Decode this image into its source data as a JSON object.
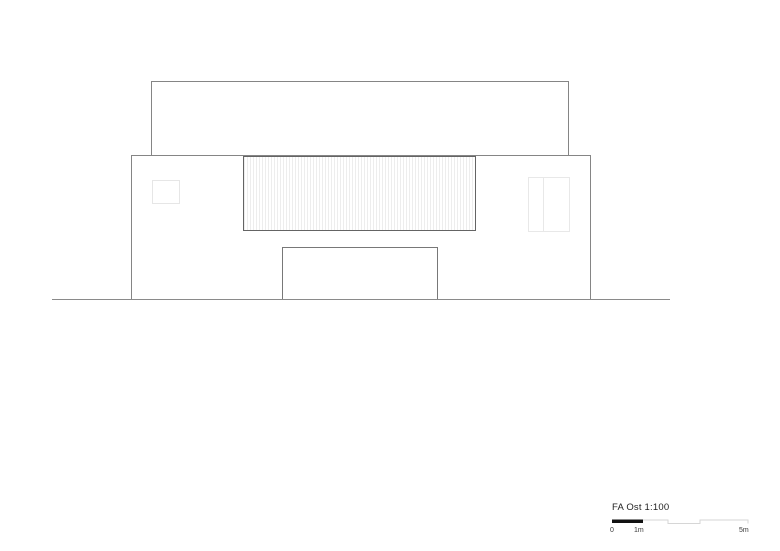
{
  "drawing": {
    "type": "architectural-elevation",
    "title_block": {
      "label": "FA Ost 1:100",
      "scale_ticks": [
        "0",
        "1m",
        "5m"
      ]
    },
    "colors": {
      "background": "#ffffff",
      "building_outline": "#858585",
      "slat_frame": "#646464",
      "slat_hatch_line": "#ededed",
      "faint_frame": "#e8e8e8",
      "ground_line": "#8a8a8a",
      "scalebar_fill": "#111111",
      "scalebar_step_line": "#d6d6d6",
      "text": "#1f1f1f"
    }
  }
}
